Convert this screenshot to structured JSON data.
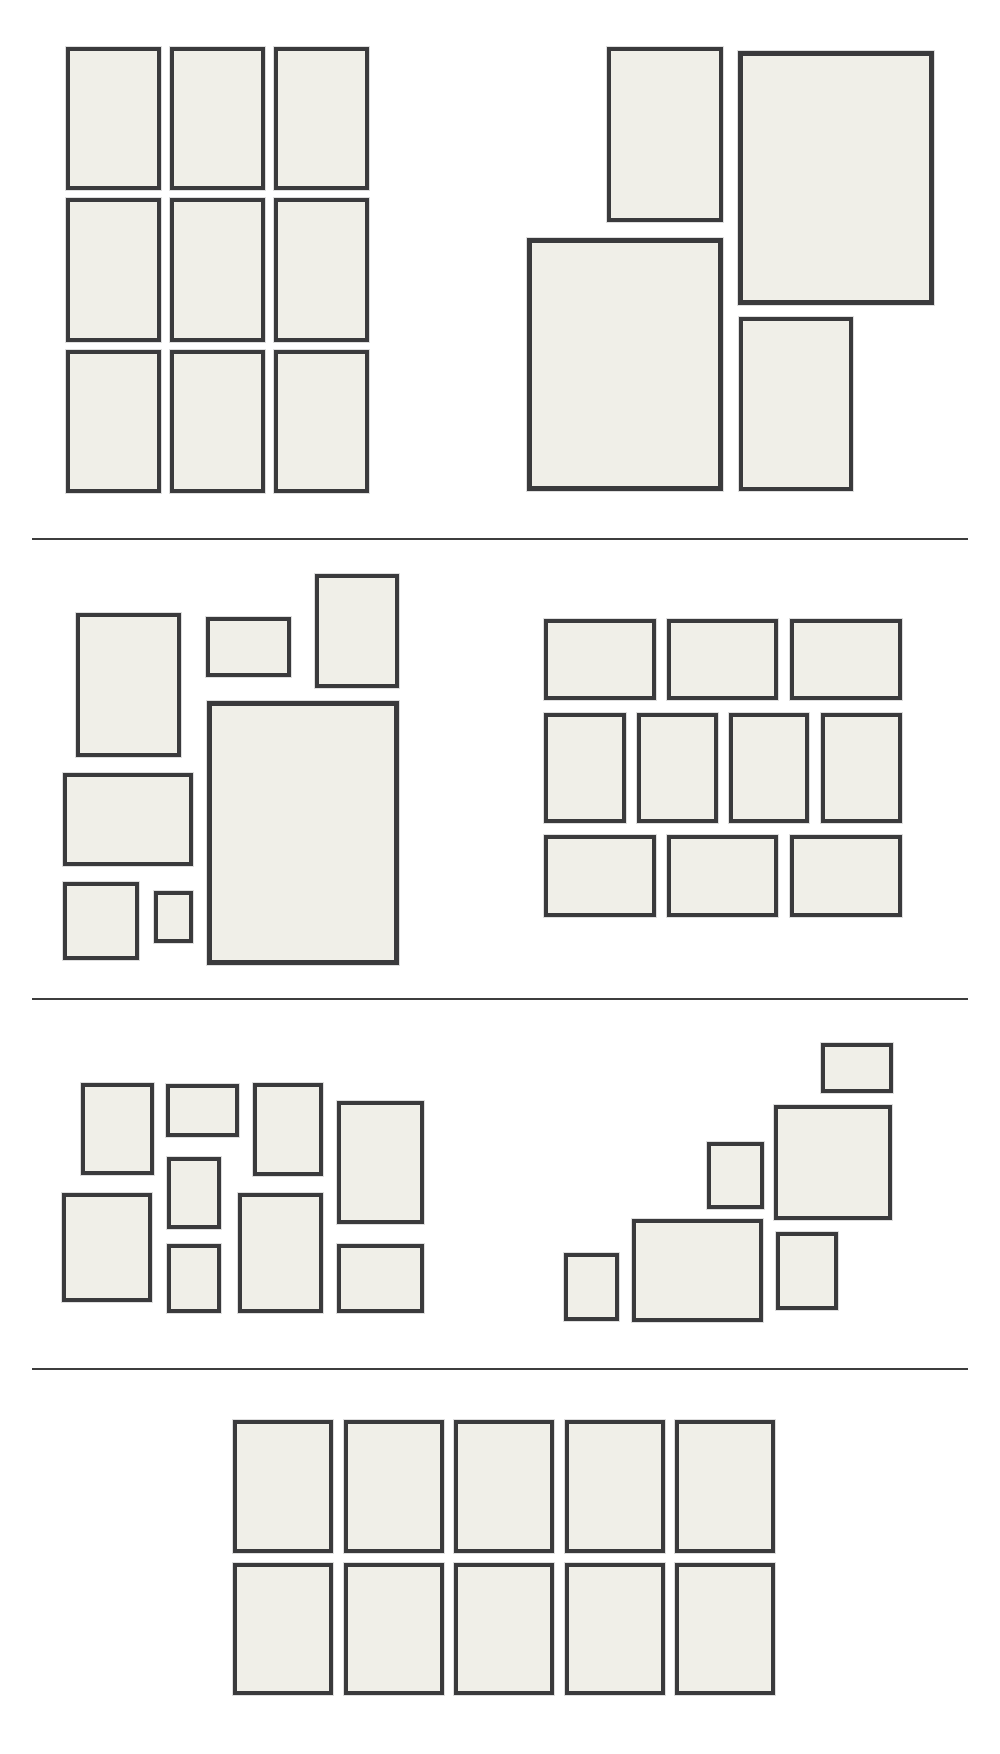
{
  "page": {
    "title": "Gallery wall frame layout templates",
    "width": 1000,
    "height": 1754,
    "background": "#ffffff"
  },
  "styles": {
    "frame_fill": "#f0efe8",
    "frame_border_color": "#3a3a3c",
    "frame_halo_color": "rgba(0,0,0,0.13)",
    "divider_color": "#3d3d3d",
    "default_border_width": 4
  },
  "dividers": [
    {
      "id": "divider-1",
      "x": 32,
      "y": 538,
      "w": 936,
      "h": 2
    },
    {
      "id": "divider-2",
      "x": 32,
      "y": 998,
      "w": 936,
      "h": 2
    },
    {
      "id": "divider-3",
      "x": 32,
      "y": 1368,
      "w": 936,
      "h": 2
    }
  ],
  "sections": [
    {
      "id": "layout-a",
      "groups": [
        {
          "id": "grid-3x3",
          "frames": [
            {
              "id": "a-grid-r1c1",
              "x": 66,
              "y": 47,
              "w": 95,
              "h": 143
            },
            {
              "id": "a-grid-r1c2",
              "x": 170,
              "y": 47,
              "w": 95,
              "h": 143
            },
            {
              "id": "a-grid-r1c3",
              "x": 274,
              "y": 47,
              "w": 95,
              "h": 143
            },
            {
              "id": "a-grid-r2c1",
              "x": 66,
              "y": 198,
              "w": 95,
              "h": 144
            },
            {
              "id": "a-grid-r2c2",
              "x": 170,
              "y": 198,
              "w": 95,
              "h": 144
            },
            {
              "id": "a-grid-r2c3",
              "x": 274,
              "y": 198,
              "w": 95,
              "h": 144
            },
            {
              "id": "a-grid-r3c1",
              "x": 66,
              "y": 350,
              "w": 95,
              "h": 143
            },
            {
              "id": "a-grid-r3c2",
              "x": 170,
              "y": 350,
              "w": 95,
              "h": 143
            },
            {
              "id": "a-grid-r3c3",
              "x": 274,
              "y": 350,
              "w": 95,
              "h": 143
            }
          ]
        },
        {
          "id": "offset-quad",
          "frames": [
            {
              "id": "a-quad-small-top-left",
              "x": 607,
              "y": 47,
              "w": 116,
              "h": 175
            },
            {
              "id": "a-quad-large-top-right",
              "x": 738,
              "y": 51,
              "w": 196,
              "h": 254,
              "bw": 5
            },
            {
              "id": "a-quad-large-bottom-left",
              "x": 527,
              "y": 238,
              "w": 196,
              "h": 253,
              "bw": 5
            },
            {
              "id": "a-quad-small-bottom-right",
              "x": 739,
              "y": 317,
              "w": 114,
              "h": 174
            }
          ]
        }
      ]
    },
    {
      "id": "layout-b",
      "groups": [
        {
          "id": "collage-left",
          "frames": [
            {
              "id": "b-collage-tall-left",
              "x": 76,
              "y": 613,
              "w": 105,
              "h": 144
            },
            {
              "id": "b-collage-small-landscape",
              "x": 206,
              "y": 617,
              "w": 85,
              "h": 60
            },
            {
              "id": "b-collage-top-portrait",
              "x": 315,
              "y": 574,
              "w": 84,
              "h": 114
            },
            {
              "id": "b-collage-large-portrait",
              "x": 207,
              "y": 701,
              "w": 192,
              "h": 264,
              "bw": 5
            },
            {
              "id": "b-collage-mid-landscape",
              "x": 63,
              "y": 773,
              "w": 130,
              "h": 93
            },
            {
              "id": "b-collage-small-square",
              "x": 63,
              "y": 882,
              "w": 76,
              "h": 78
            },
            {
              "id": "b-collage-tiny-portrait",
              "x": 154,
              "y": 891,
              "w": 39,
              "h": 52
            }
          ]
        },
        {
          "id": "brick-grid",
          "frames": [
            {
              "id": "b-brick-r1c1",
              "x": 544,
              "y": 619,
              "w": 112,
              "h": 81
            },
            {
              "id": "b-brick-r1c2",
              "x": 667,
              "y": 619,
              "w": 111,
              "h": 81
            },
            {
              "id": "b-brick-r1c3",
              "x": 790,
              "y": 619,
              "w": 112,
              "h": 81
            },
            {
              "id": "b-brick-r2c1",
              "x": 544,
              "y": 713,
              "w": 82,
              "h": 110
            },
            {
              "id": "b-brick-r2c2",
              "x": 637,
              "y": 713,
              "w": 81,
              "h": 110
            },
            {
              "id": "b-brick-r2c3",
              "x": 729,
              "y": 713,
              "w": 80,
              "h": 110
            },
            {
              "id": "b-brick-r2c4",
              "x": 821,
              "y": 713,
              "w": 81,
              "h": 110
            },
            {
              "id": "b-brick-r3c1",
              "x": 544,
              "y": 835,
              "w": 112,
              "h": 82
            },
            {
              "id": "b-brick-r3c2",
              "x": 667,
              "y": 835,
              "w": 111,
              "h": 82
            },
            {
              "id": "b-brick-r3c3",
              "x": 790,
              "y": 835,
              "w": 112,
              "h": 82
            }
          ]
        }
      ]
    },
    {
      "id": "layout-c",
      "groups": [
        {
          "id": "mosaic-left",
          "frames": [
            {
              "id": "c-mosaic-portrait-1",
              "x": 81,
              "y": 1083,
              "w": 73,
              "h": 92
            },
            {
              "id": "c-mosaic-landscape-top",
              "x": 166,
              "y": 1084,
              "w": 73,
              "h": 53
            },
            {
              "id": "c-mosaic-portrait-2",
              "x": 253,
              "y": 1083,
              "w": 70,
              "h": 93
            },
            {
              "id": "c-mosaic-tall-right",
              "x": 337,
              "y": 1101,
              "w": 87,
              "h": 123
            },
            {
              "id": "c-mosaic-small-center",
              "x": 167,
              "y": 1157,
              "w": 54,
              "h": 72
            },
            {
              "id": "c-mosaic-large-left",
              "x": 62,
              "y": 1193,
              "w": 90,
              "h": 109
            },
            {
              "id": "c-mosaic-small-bottom",
              "x": 167,
              "y": 1244,
              "w": 54,
              "h": 69
            },
            {
              "id": "c-mosaic-large-center",
              "x": 238,
              "y": 1193,
              "w": 85,
              "h": 120
            },
            {
              "id": "c-mosaic-landscape-bottom",
              "x": 337,
              "y": 1244,
              "w": 87,
              "h": 69
            }
          ]
        },
        {
          "id": "staircase-right",
          "frames": [
            {
              "id": "c-stair-small-landscape-top",
              "x": 821,
              "y": 1043,
              "w": 72,
              "h": 50
            },
            {
              "id": "c-stair-large-square",
              "x": 774,
              "y": 1105,
              "w": 118,
              "h": 115
            },
            {
              "id": "c-stair-small-portrait-mid",
              "x": 707,
              "y": 1142,
              "w": 57,
              "h": 67
            },
            {
              "id": "c-stair-large-landscape",
              "x": 632,
              "y": 1219,
              "w": 131,
              "h": 103
            },
            {
              "id": "c-stair-small-square-left",
              "x": 564,
              "y": 1253,
              "w": 55,
              "h": 68
            },
            {
              "id": "c-stair-portrait-right",
              "x": 776,
              "y": 1232,
              "w": 62,
              "h": 78
            }
          ]
        }
      ]
    },
    {
      "id": "layout-d",
      "groups": [
        {
          "id": "grid-2x5",
          "frames": [
            {
              "id": "d-grid-r1c1",
              "x": 233,
              "y": 1420,
              "w": 100,
              "h": 133
            },
            {
              "id": "d-grid-r1c2",
              "x": 344,
              "y": 1420,
              "w": 100,
              "h": 133
            },
            {
              "id": "d-grid-r1c3",
              "x": 454,
              "y": 1420,
              "w": 100,
              "h": 133
            },
            {
              "id": "d-grid-r1c4",
              "x": 565,
              "y": 1420,
              "w": 100,
              "h": 133
            },
            {
              "id": "d-grid-r1c5",
              "x": 675,
              "y": 1420,
              "w": 100,
              "h": 133
            },
            {
              "id": "d-grid-r2c1",
              "x": 233,
              "y": 1563,
              "w": 100,
              "h": 132
            },
            {
              "id": "d-grid-r2c2",
              "x": 344,
              "y": 1563,
              "w": 100,
              "h": 132
            },
            {
              "id": "d-grid-r2c3",
              "x": 454,
              "y": 1563,
              "w": 100,
              "h": 132
            },
            {
              "id": "d-grid-r2c4",
              "x": 565,
              "y": 1563,
              "w": 100,
              "h": 132
            },
            {
              "id": "d-grid-r2c5",
              "x": 675,
              "y": 1563,
              "w": 100,
              "h": 132
            }
          ]
        }
      ]
    }
  ]
}
